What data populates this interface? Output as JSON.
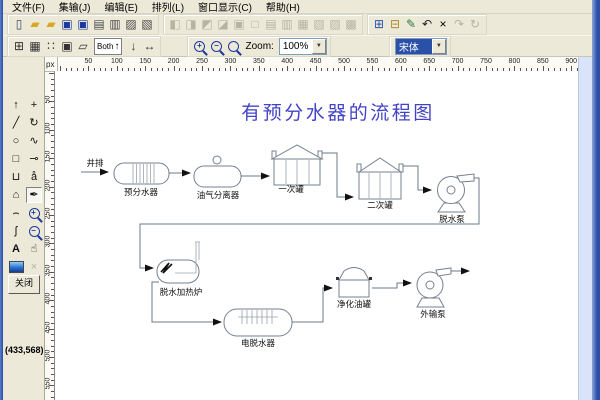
{
  "window": {
    "coords_status": "(433,568)"
  },
  "ui": {
    "dropdown_arrow": "▼"
  },
  "menu": {
    "items": [
      {
        "name": "file",
        "label": "文件(F)"
      },
      {
        "name": "gathering",
        "label": "集输(J)"
      },
      {
        "name": "edit",
        "label": "编辑(E)"
      },
      {
        "name": "arrange",
        "label": "排列(L)"
      },
      {
        "name": "window-display",
        "label": "窗口显示(C)"
      },
      {
        "name": "help",
        "label": "帮助(H)"
      }
    ]
  },
  "toolbar_file": {
    "groups": [
      {
        "name": "file",
        "items": [
          {
            "name": "new-drawing",
            "glyph": "▯",
            "color": "#3a4a66"
          },
          {
            "name": "open-drawing",
            "glyph": "▰",
            "color": "#d9a722"
          },
          {
            "name": "open-template",
            "glyph": "▰",
            "color": "#d9a722"
          },
          {
            "name": "save",
            "glyph": "▣",
            "color": "#1c3a9e"
          },
          {
            "name": "save-as",
            "glyph": "▣",
            "color": "#1c3a9e"
          },
          {
            "name": "print",
            "glyph": "▤",
            "color": "#4a4a4a"
          },
          {
            "name": "print-preview",
            "glyph": "▥",
            "color": "#4a4a4a"
          },
          {
            "name": "page-setup",
            "glyph": "▨",
            "color": "#4a4a4a"
          },
          {
            "name": "printer-setup",
            "glyph": "▧",
            "color": "#4a4a4a"
          }
        ]
      },
      {
        "name": "arrange",
        "items": [
          {
            "name": "bring-to-front",
            "glyph": "◧",
            "disabled": true
          },
          {
            "name": "send-to-back",
            "glyph": "◨",
            "disabled": true
          },
          {
            "name": "bring-forward",
            "glyph": "◩",
            "disabled": true
          },
          {
            "name": "send-backward",
            "glyph": "◪",
            "disabled": true
          },
          {
            "name": "group",
            "glyph": "▣",
            "disabled": true
          },
          {
            "name": "ungroup",
            "glyph": "□",
            "disabled": true
          },
          {
            "name": "align-left",
            "glyph": "▤",
            "disabled": true
          },
          {
            "name": "align-center",
            "glyph": "▥",
            "disabled": true
          },
          {
            "name": "align-right",
            "glyph": "▦",
            "disabled": true
          },
          {
            "name": "flip-horizontal",
            "glyph": "▧",
            "disabled": true
          },
          {
            "name": "flip-vertical",
            "glyph": "▨",
            "disabled": true
          },
          {
            "name": "rotate-object",
            "glyph": "▩",
            "disabled": true
          }
        ]
      },
      {
        "name": "edit",
        "items": [
          {
            "name": "copy",
            "glyph": "⊞",
            "color": "#2a52b0"
          },
          {
            "name": "paste",
            "glyph": "⊟",
            "color": "#b08a2a"
          },
          {
            "name": "format-painter",
            "glyph": "✎",
            "color": "#2a7a3a"
          },
          {
            "name": "undo",
            "glyph": "↶",
            "color": "#222222"
          },
          {
            "name": "delete",
            "glyph": "×",
            "color": "#000000",
            "bold": true
          },
          {
            "name": "redo",
            "glyph": "↷",
            "disabled": true
          },
          {
            "name": "refresh",
            "glyph": "↻",
            "disabled": true
          }
        ]
      }
    ]
  },
  "toolbar_view": {
    "grid_items": [
      {
        "name": "snap-to-grid",
        "glyph": "⊞"
      },
      {
        "name": "show-grid",
        "glyph": "▦"
      },
      {
        "name": "dot-grid",
        "glyph": "∷"
      },
      {
        "name": "grid-settings",
        "glyph": "▣"
      },
      {
        "name": "page-orientation",
        "glyph": "▱"
      }
    ],
    "both_label": "Both",
    "both_arrow": "↑",
    "flow_items": [
      {
        "name": "vertical-direction",
        "glyph": "↓"
      },
      {
        "name": "horizontal-direction",
        "glyph": "↔"
      }
    ],
    "zoom": {
      "label": "Zoom:",
      "value": "100%"
    },
    "font": {
      "value": "宋体"
    }
  },
  "toolbox": {
    "close_label": "关闭",
    "tools": [
      {
        "name": "select",
        "glyph": "↑"
      },
      {
        "name": "crosshair",
        "glyph": "+"
      },
      {
        "name": "line",
        "glyph": "╱"
      },
      {
        "name": "rotate",
        "glyph": "↻"
      },
      {
        "name": "ellipse",
        "glyph": "○"
      },
      {
        "name": "connector",
        "glyph": "∿"
      },
      {
        "name": "rectangle",
        "glyph": "□"
      },
      {
        "name": "node",
        "glyph": "⊸"
      },
      {
        "name": "open-shape",
        "glyph": "⊔"
      },
      {
        "name": "spray",
        "glyph": "å"
      },
      {
        "name": "polygon",
        "glyph": "⌂"
      },
      {
        "name": "pen",
        "glyph": "✒",
        "selected": true
      },
      {
        "name": "arc",
        "glyph": "⌢"
      },
      {
        "name": "zoom-in",
        "type": "lens",
        "sign": "+"
      },
      {
        "name": "freehand",
        "glyph": "ʃ"
      },
      {
        "name": "zoom-out",
        "type": "lens",
        "sign": "−"
      },
      {
        "name": "text",
        "glyph": "A",
        "bold": true
      },
      {
        "name": "pan",
        "glyph": "☝"
      },
      {
        "name": "image",
        "type": "image"
      },
      {
        "name": "delete-object",
        "glyph": "×",
        "disabled": true
      }
    ]
  },
  "rulers": {
    "unit": "px",
    "h_labels": [
      50,
      100,
      150,
      200,
      250,
      300,
      350,
      400,
      450,
      500,
      550,
      600,
      650,
      700,
      750,
      800,
      850,
      900
    ],
    "v_labels": [
      50,
      100,
      150,
      200,
      250,
      300,
      350,
      400,
      450,
      500,
      550
    ]
  },
  "diagram": {
    "title": "有预分水器的流程图",
    "labels": {
      "inlet": "井排",
      "pre_separator": "预分水器",
      "gas_separator": "油气分离器",
      "primary_tank": "一次罐",
      "secondary_tank": "二次罐",
      "dewatering_pump": "脱水泵",
      "heater": "脱水加热炉",
      "electric_dehydrator": "电脱水器",
      "clean_oil_tank": "净化油罐",
      "export_pump": "外输泵"
    }
  }
}
